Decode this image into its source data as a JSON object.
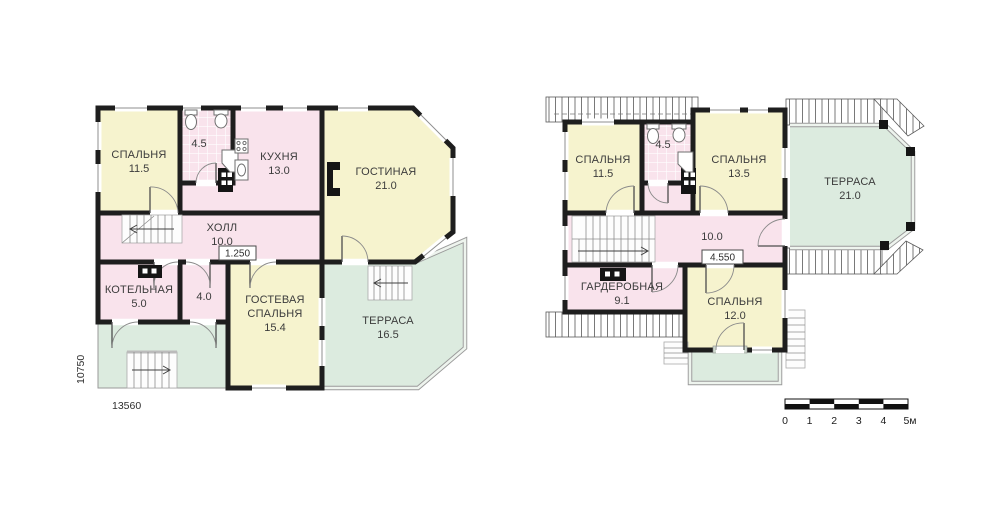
{
  "colors": {
    "room_yellow": "#f6f3ce",
    "room_pink": "#f9e3ec",
    "outdoor_green": "#dcebdf",
    "wall_black": "#1e1e1e"
  },
  "floor1": {
    "bedroom": {
      "name": "СПАЛЬНЯ",
      "area": "11.5"
    },
    "bathroom": {
      "area": "4.5"
    },
    "kitchen": {
      "name": "КУХНЯ",
      "area": "13.0"
    },
    "living_room": {
      "name": "ГОСТИНАЯ",
      "area": "21.0"
    },
    "hall": {
      "name": "ХОЛЛ",
      "area": "10.0"
    },
    "boiler_room": {
      "name": "КОТЕЛЬНАЯ",
      "area": "5.0"
    },
    "storage": {
      "area": "4.0"
    },
    "guest_bedroom": {
      "name_line1": "ГОСТЕВАЯ",
      "name_line2": "СПАЛЬНЯ",
      "area": "15.4"
    },
    "terrace": {
      "name": "ТЕРРАСА",
      "area": "16.5"
    },
    "elevation_mark": "1.250",
    "dim_horizontal": "13560",
    "dim_vertical": "10750"
  },
  "floor2": {
    "bedroom_left": {
      "name": "СПАЛЬНЯ",
      "area": "11.5"
    },
    "bathroom": {
      "area": "4.5"
    },
    "bedroom_right": {
      "name": "СПАЛЬНЯ",
      "area": "13.5"
    },
    "terrace": {
      "name": "ТЕРРАСА",
      "area": "21.0"
    },
    "hall": {
      "area": "10.0"
    },
    "wardrobe": {
      "name": "ГАРДЕРОБНАЯ",
      "area": "9.1"
    },
    "bedroom_bottom": {
      "name": "СПАЛЬНЯ",
      "area": "12.0"
    },
    "elevation_mark": "4.550"
  },
  "scale_bar": {
    "ticks": [
      "0",
      "1",
      "2",
      "3",
      "4",
      "5м"
    ]
  }
}
